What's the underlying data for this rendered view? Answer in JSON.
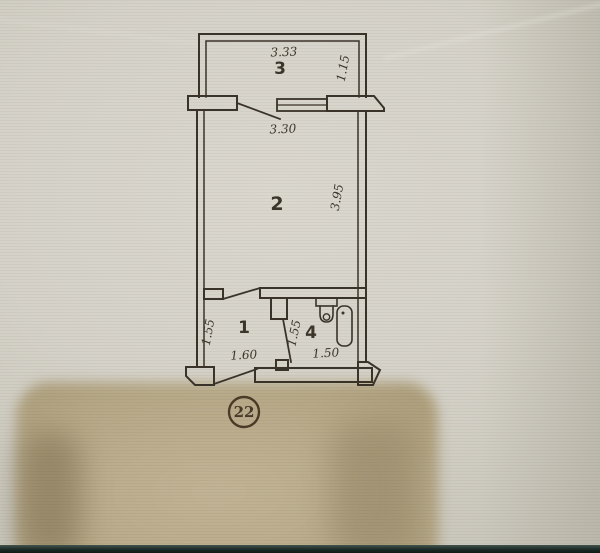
{
  "plan": {
    "type": "apartment-floor-plan",
    "unit_number": "22",
    "ink_color": "#3a332a",
    "paper_color": "#d5d2c9",
    "stain_color": "#b0a181",
    "rooms": {
      "balcony": {
        "number": "3",
        "width": "3.33",
        "depth": "1.15"
      },
      "living": {
        "number": "2",
        "width": "3.30",
        "depth": "3.95"
      },
      "hall": {
        "number": "1",
        "width": "1.60",
        "depth": "1.55"
      },
      "bath": {
        "number": "4",
        "width": "1.50",
        "depth": "1.55"
      }
    },
    "fixtures": [
      "toilet",
      "bathtub"
    ]
  }
}
